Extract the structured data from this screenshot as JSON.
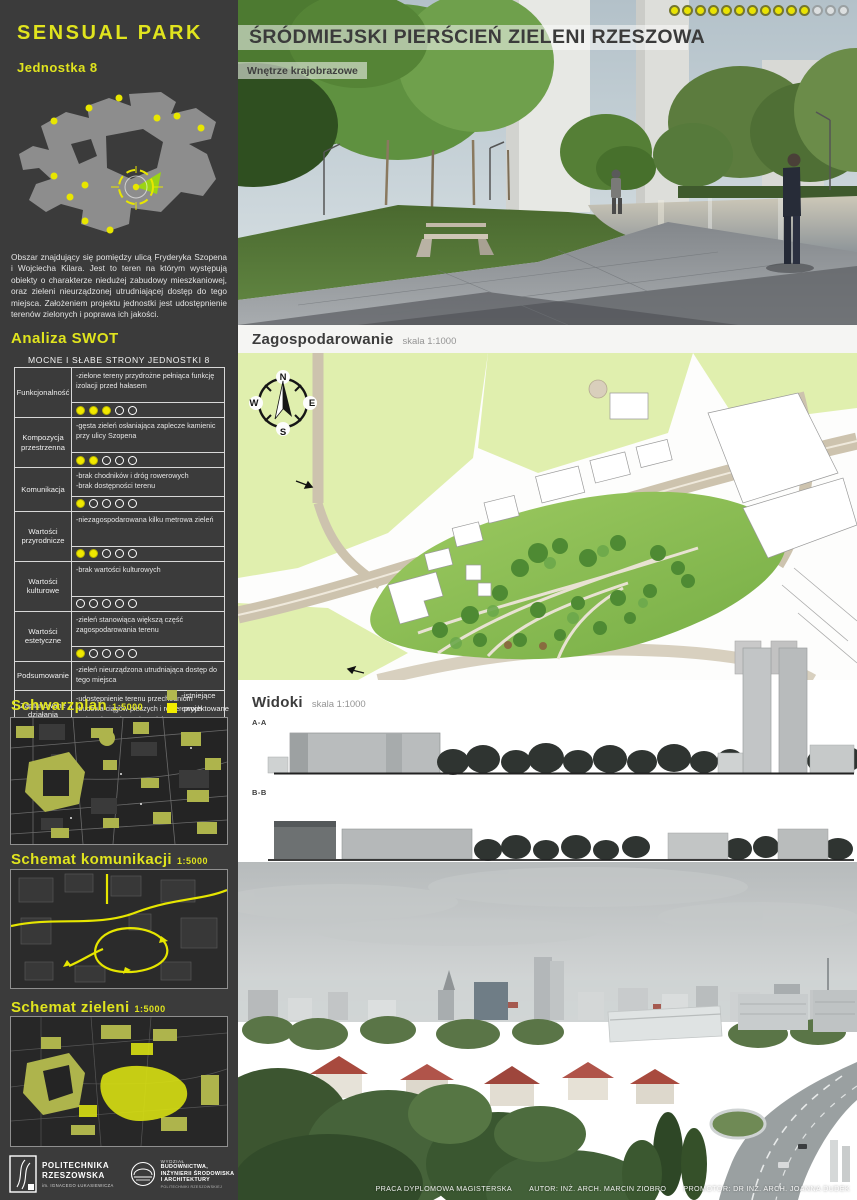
{
  "sidebar": {
    "title": "SENSUAL PARK",
    "subtitle": "Jednostka 8",
    "description": "Obszar znajdujący się pomiędzy ulicą Fryderyka Szopena i Wojciecha Kilara. Jest to teren na którym występują obiekty o charakterze niedużej zabudowy mieszkaniowej, oraz zieleni nieurządzonej utrudniającej dostęp do tego miejsca. Założeniem projektu jednostki jest udostępnienie terenów zielonych i poprawa ich jakości.",
    "swot_heading": "Analiza SWOT",
    "swot_table_title": "MOCNE I SŁABE STRONY JEDNOSTKI 8",
    "swot_rows": [
      {
        "category": "Funkcjonalność",
        "lines": [
          "-zielone tereny przydrożne pełniąca funkcję izolacji przed hałasem"
        ],
        "rating": 3,
        "max": 5
      },
      {
        "category": "Kompozycja przestrzenna",
        "lines": [
          "-gęsta zieleń osłaniająca zaplecze kamienic przy ulicy Szopena"
        ],
        "rating": 2,
        "max": 5
      },
      {
        "category": "Komunikacja",
        "lines": [
          "-brak chodników i dróg rowerowych",
          "-brak dostępności terenu"
        ],
        "rating": 1,
        "max": 5
      },
      {
        "category": "Wartości przyrodnicze",
        "lines": [
          "-niezagospodarowana kilku metrowa zieleń"
        ],
        "rating": 2,
        "max": 5
      },
      {
        "category": "Wartości kulturowe",
        "lines": [
          "-brak wartości  kulturowych"
        ],
        "rating": 0,
        "max": 5
      },
      {
        "category": "Wartości estetyczne",
        "lines": [
          "-zieleń stanowiąca większą część zagospodarowania terenu"
        ],
        "rating": 1,
        "max": 5
      },
      {
        "category": "Podsumowanie",
        "lines": [
          "-zieleń nieurządzona utrudniająca dostęp do tego miejsca"
        ],
        "rating": null,
        "max": 0
      },
      {
        "category": "Zaplanowane działania naprawcze",
        "lines": [
          "-udostępnienie terenu przechodniom",
          "-budowa ciągów pieszych i rowerowych",
          "-zainstalowanie wodotrysków wygłuszających hałas z ulicy"
        ],
        "rating": null,
        "max": 0
      }
    ],
    "legend": {
      "existing": "-istniejące",
      "planned": "-projektowane"
    },
    "maps": [
      {
        "label": "Schwarzplan",
        "scale": "1:5000"
      },
      {
        "label": "Schemat komunikacji",
        "scale": "1:5000"
      },
      {
        "label": "Schemat zieleni",
        "scale": "1:5000"
      }
    ],
    "logos": {
      "university_name_1": "POLITECHNIKA",
      "university_name_2": "RZESZOWSKA",
      "university_sub": "im. IGNACEGO ŁUKASIEWICZA",
      "faculty_pre": "WYDZIAŁ",
      "faculty_1": "BUDOWNICTWA,",
      "faculty_2": "INŻYNIERII ŚRODOWISKA",
      "faculty_3": "I ARCHITEKTURY",
      "faculty_sub": "POLITECHNIKI RZESZOWSKIEJ"
    }
  },
  "main": {
    "title": "ŚRÓDMIEJSKI PIERŚCIEŃ ZIELENI RZESZOWA",
    "subtitle": "Wnętrze krajobrazowe",
    "progress": {
      "filled": 11,
      "total": 14
    },
    "plan": {
      "heading": "Zagospodarowanie",
      "scale": "skala 1:1000",
      "compass": {
        "n": "N",
        "e": "E",
        "s": "S",
        "w": "W"
      }
    },
    "views": {
      "heading": "Widoki",
      "scale": "skala 1:1000",
      "section_a": "A-A",
      "section_b": "B-B"
    },
    "footer": {
      "thesis": "PRACA DYPLOMOWA MAGISTERSKA",
      "author": "AUTOR: INŻ. ARCH. MARCIN ZIOBRO",
      "promoter": "PROMOTOR: DR INŻ. ARCH. JOANNA DUDEK"
    }
  },
  "colors": {
    "accent_yellow": "#e0e41e",
    "planned_yellow": "#f2ec00",
    "existing_olive": "#b2b84f",
    "sidebar_bg": "#3b3b3b"
  }
}
